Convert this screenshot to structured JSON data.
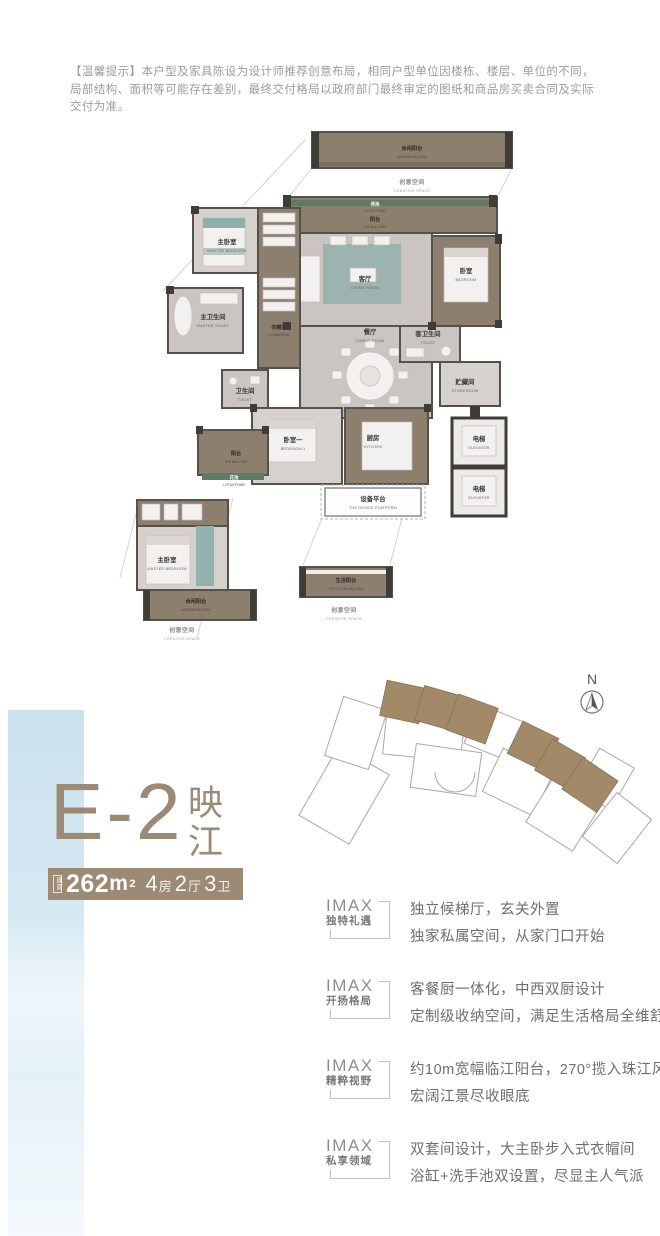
{
  "colors": {
    "accent_brown": "#9c8a74",
    "plan_brown": "#8d7f6e",
    "plan_gray": "#cbc5c2",
    "teal_accent": "#8fafab",
    "pond_green": "#5e7b63",
    "wash_blue": "#cde2ee",
    "wall_dark": "#3f3c38",
    "body_text_gray": "#6e6e6e"
  },
  "disclaimer": {
    "text": "【温馨提示】本户型及家具陈设为设计师推荐创意布局，相同户型单位因楼栋、楼层、单位的不同，局部结构、面积等可能存在差别，最终交付格局以政府部门最终审定的图纸和商品房买卖合同及实际交付为准。"
  },
  "floorplan": {
    "leisure_balcony_top": {
      "zh": "休闲阳台",
      "en": "LEISURE BALCONY"
    },
    "creative_space_top": {
      "zh": "创意空间",
      "en": "CREATIVE SPACE"
    },
    "lotus_pond_top": {
      "zh": "荷池",
      "en": "LOTUS POND"
    },
    "balcony_top": {
      "zh": "阳台",
      "en": "THE BALCONY"
    },
    "master_bedroom": {
      "zh": "主卧室",
      "en": "MASTER BEDROOM"
    },
    "master_toilet": {
      "zh": "主卫生间",
      "en": "MASTER TOILET"
    },
    "cloakroom": {
      "zh": "衣帽间",
      "en": "CLOAKROOM"
    },
    "living_room": {
      "zh": "客厅",
      "en": "LIVING ROOM"
    },
    "bedroom": {
      "zh": "卧室",
      "en": "BEDROOM"
    },
    "dining_room": {
      "zh": "餐厅",
      "en": "DINING ROOM"
    },
    "guest_toilet": {
      "zh": "客卫生间",
      "en": "TOILET"
    },
    "storeroom": {
      "zh": "贮藏间",
      "en": "STOREROOM"
    },
    "toilet": {
      "zh": "卫生间",
      "en": "TOILET"
    },
    "bedroom1": {
      "zh": "卧室一",
      "en": "BEDROOM 1"
    },
    "kitchen": {
      "zh": "厨房",
      "en": "KITCHEN"
    },
    "balcony_left": {
      "zh": "阳台",
      "en": "THE BALCONY"
    },
    "lotus_pond_left": {
      "zh": "花池",
      "en": "LOTUS POND"
    },
    "device_platform": {
      "zh": "设备平台",
      "en": "THE DEVICE PLATFORM"
    },
    "elevator1": {
      "zh": "电梯",
      "en": "ELEVATOR"
    },
    "elevator2": {
      "zh": "电梯",
      "en": "ELEVATOR"
    },
    "master_bedroom_detail": {
      "zh": "主卧室",
      "en": "MASTER BEDROOM"
    },
    "leisure_balcony_detail": {
      "zh": "休闲阳台",
      "en": "LEISURE BALCONY"
    },
    "creative_space_detail": {
      "zh": "创意空间",
      "en": "CREATIVE SPACE"
    },
    "life_balcony": {
      "zh": "生活阳台",
      "en": "LIFE IN THE BALCONY"
    },
    "creative_space_bottom": {
      "zh": "创意空间",
      "en": "CREATIVE SPACE"
    }
  },
  "siteplan": {
    "north_label": "N"
  },
  "unit": {
    "code": "E-2",
    "name_chars": [
      "映",
      "江"
    ],
    "area_label": "建面",
    "area_value": "262",
    "area_unit": "m",
    "area_exp": "2",
    "spec": [
      {
        "n": "4",
        "u": "房"
      },
      {
        "n": "2",
        "u": "厅"
      },
      {
        "n": "3",
        "u": "卫"
      }
    ]
  },
  "features": [
    {
      "brand": "IMAX",
      "subtitle": "独特礼遇",
      "line1": "独立候梯厅，玄关外置",
      "line2": "独家私属空间，从家门口开始"
    },
    {
      "brand": "IMAX",
      "subtitle": "开扬格局",
      "line1": "客餐厨一体化，中西双厨设计",
      "line2": "定制级收纳空间，满足生活格局全维舒享"
    },
    {
      "brand": "IMAX",
      "subtitle": "精粹视野",
      "line1": "约10m宽幅临江阳台，270°揽入珠江风光",
      "line2": "宏阔江景尽收眼底"
    },
    {
      "brand": "IMAX",
      "subtitle": "私享领域",
      "line1": "双套间设计，大主卧步入式衣帽间",
      "line2": "浴缸+洗手池双设置，尽显主人气派"
    }
  ]
}
